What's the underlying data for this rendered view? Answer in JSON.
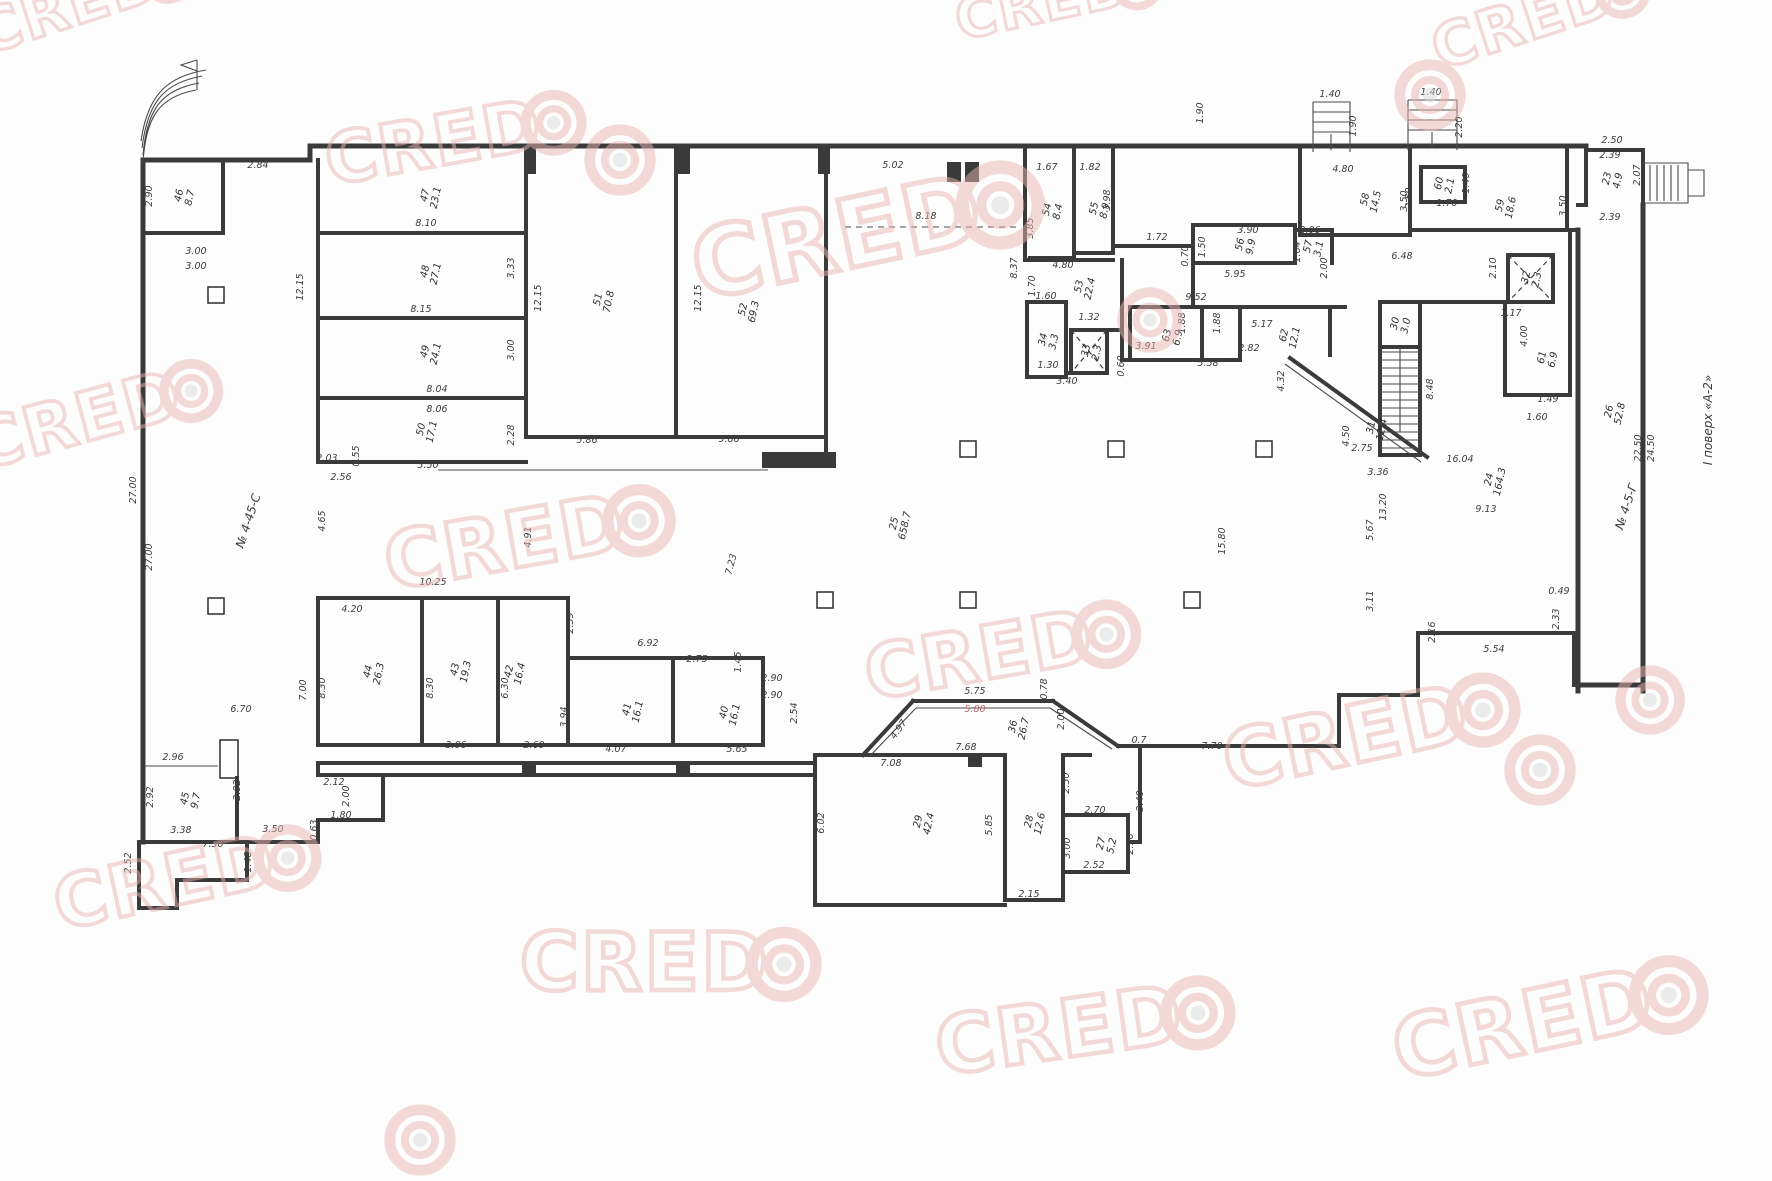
{
  "document": {
    "type": "floor-plan-scan",
    "floor_note": "І поверх «А-2»",
    "annotations": [
      {
        "t": "№ 4-45-С",
        "x": 252,
        "y": 522,
        "r": -72
      },
      {
        "t": "№ 4-5-Г",
        "x": 1630,
        "y": 508,
        "r": -72
      },
      {
        "t": "І поверх «А-2»",
        "x": 1712,
        "y": 420,
        "r": -90
      }
    ]
  },
  "watermark": {
    "text": "CRED",
    "color": "#e9b2b2",
    "center_color": "#d9d9d9",
    "opacity": 0.5,
    "items": [
      {
        "x": -15,
        "y": 55,
        "s": 60,
        "r": -18,
        "t": "logo"
      },
      {
        "x": 960,
        "y": 40,
        "s": 56,
        "r": -12,
        "t": "logo"
      },
      {
        "x": 1440,
        "y": 70,
        "s": 60,
        "r": -18,
        "t": "logo"
      },
      {
        "x": 330,
        "y": 185,
        "s": 70,
        "r": -10,
        "t": "logo"
      },
      {
        "x": 620,
        "y": 160,
        "s": 72,
        "r": 0,
        "t": "target"
      },
      {
        "x": 700,
        "y": 300,
        "s": 95,
        "r": -12,
        "t": "logo"
      },
      {
        "x": 1150,
        "y": 320,
        "s": 66,
        "r": 0,
        "t": "target"
      },
      {
        "x": 1430,
        "y": 95,
        "s": 72,
        "r": 0,
        "t": "target"
      },
      {
        "x": -20,
        "y": 470,
        "s": 68,
        "r": -15,
        "t": "logo"
      },
      {
        "x": 390,
        "y": 590,
        "s": 78,
        "r": -10,
        "t": "logo"
      },
      {
        "x": 870,
        "y": 700,
        "s": 74,
        "r": -10,
        "t": "logo"
      },
      {
        "x": 1230,
        "y": 790,
        "s": 80,
        "r": -12,
        "t": "logo"
      },
      {
        "x": 1540,
        "y": 770,
        "s": 72,
        "r": 0,
        "t": "target"
      },
      {
        "x": 60,
        "y": 930,
        "s": 72,
        "r": -12,
        "t": "logo"
      },
      {
        "x": 520,
        "y": 990,
        "s": 80,
        "r": 0,
        "t": "logo"
      },
      {
        "x": 940,
        "y": 1075,
        "s": 80,
        "r": -8,
        "t": "logo"
      },
      {
        "x": 1400,
        "y": 1080,
        "s": 85,
        "r": -12,
        "t": "logo"
      },
      {
        "x": 420,
        "y": 1140,
        "s": 72,
        "r": 0,
        "t": "target"
      },
      {
        "x": 1650,
        "y": 700,
        "s": 70,
        "r": 0,
        "t": "target"
      }
    ]
  },
  "rooms": [
    {
      "num": "46",
      "area": "8.7",
      "x": 182,
      "y": 196
    },
    {
      "num": "47",
      "area": "23.1",
      "x": 428,
      "y": 196
    },
    {
      "num": "48",
      "area": "27.1",
      "x": 428,
      "y": 272
    },
    {
      "num": "49",
      "area": "24.1",
      "x": 428,
      "y": 352
    },
    {
      "num": "50",
      "area": "17.1",
      "x": 424,
      "y": 430
    },
    {
      "num": "51",
      "area": "70.8",
      "x": 601,
      "y": 300
    },
    {
      "num": "52",
      "area": "69.3",
      "x": 746,
      "y": 310
    },
    {
      "num": "53",
      "area": "22.4",
      "x": 1082,
      "y": 287
    },
    {
      "num": "54",
      "area": "8.4",
      "x": 1050,
      "y": 210
    },
    {
      "num": "55",
      "area": "8.9",
      "x": 1097,
      "y": 209
    },
    {
      "num": "56",
      "area": "9.9",
      "x": 1243,
      "y": 245
    },
    {
      "num": "57",
      "area": "3.1",
      "x": 1311,
      "y": 247
    },
    {
      "num": "58",
      "area": "14.5",
      "x": 1368,
      "y": 200
    },
    {
      "num": "59",
      "area": "18.6",
      "x": 1503,
      "y": 206
    },
    {
      "num": "60",
      "area": "2.1",
      "x": 1442,
      "y": 184
    },
    {
      "num": "61",
      "area": "6.9",
      "x": 1545,
      "y": 358
    },
    {
      "num": "62",
      "area": "12.1",
      "x": 1287,
      "y": 336
    },
    {
      "num": "63",
      "area": "6.9",
      "x": 1170,
      "y": 336
    },
    {
      "num": "34",
      "area": "3.3",
      "x": 1046,
      "y": 340
    },
    {
      "num": "33",
      "area": "2.3",
      "x": 1089,
      "y": 351
    },
    {
      "num": "32",
      "area": "2.3",
      "x": 1529,
      "y": 278
    },
    {
      "num": "30",
      "area": "3.0",
      "x": 1398,
      "y": 324
    },
    {
      "num": "31",
      "area": "12.4",
      "x": 1374,
      "y": 428
    },
    {
      "num": "36",
      "area": "26.7",
      "x": 1016,
      "y": 727
    },
    {
      "num": "29",
      "area": "42.4",
      "x": 921,
      "y": 822
    },
    {
      "num": "28",
      "area": "12.6",
      "x": 1032,
      "y": 822
    },
    {
      "num": "27",
      "area": "5.2",
      "x": 1104,
      "y": 844
    },
    {
      "num": "45",
      "area": "9.7",
      "x": 188,
      "y": 799
    },
    {
      "num": "44",
      "area": "26.3",
      "x": 371,
      "y": 672
    },
    {
      "num": "43",
      "area": "19.3",
      "x": 458,
      "y": 670
    },
    {
      "num": "42",
      "area": "16.4",
      "x": 512,
      "y": 672
    },
    {
      "num": "41",
      "area": "16.1",
      "x": 630,
      "y": 710
    },
    {
      "num": "40",
      "area": "16.1",
      "x": 727,
      "y": 713
    },
    {
      "num": "25",
      "area": "658.7",
      "x": 897,
      "y": 524
    },
    {
      "num": "24",
      "area": "164.3",
      "x": 1492,
      "y": 480
    },
    {
      "num": "26",
      "area": "52.8",
      "x": 1612,
      "y": 412
    },
    {
      "num": "23",
      "area": "4.9",
      "x": 1610,
      "y": 179
    }
  ],
  "dims": [
    {
      "t": "2.84",
      "x": 258,
      "y": 168,
      "r": 0
    },
    {
      "t": "2.90",
      "x": 152,
      "y": 196,
      "r": 90
    },
    {
      "t": "3.00",
      "x": 196,
      "y": 254,
      "r": 0
    },
    {
      "t": "3.00",
      "x": 196,
      "y": 269,
      "r": 0
    },
    {
      "t": "8.10",
      "x": 426,
      "y": 226,
      "r": 0
    },
    {
      "t": "12.15",
      "x": 303,
      "y": 287,
      "r": 90
    },
    {
      "t": "3.33",
      "x": 514,
      "y": 268,
      "r": 90
    },
    {
      "t": "8.15",
      "x": 421,
      "y": 312,
      "r": 0
    },
    {
      "t": "3.00",
      "x": 514,
      "y": 350,
      "r": 90
    },
    {
      "t": "8.04",
      "x": 437,
      "y": 392,
      "r": 0
    },
    {
      "t": "8.06",
      "x": 437,
      "y": 412,
      "r": 0
    },
    {
      "t": "2.28",
      "x": 514,
      "y": 435,
      "r": 90
    },
    {
      "t": "2.03",
      "x": 327,
      "y": 461,
      "r": 0
    },
    {
      "t": "2.56",
      "x": 341,
      "y": 480,
      "r": 0
    },
    {
      "t": "0.55",
      "x": 359,
      "y": 456,
      "r": 90
    },
    {
      "t": "5.50",
      "x": 428,
      "y": 468,
      "r": 0
    },
    {
      "t": "12.15",
      "x": 541,
      "y": 298,
      "r": 90
    },
    {
      "t": "12.15",
      "x": 701,
      "y": 298,
      "r": 90
    },
    {
      "t": "5.86",
      "x": 587,
      "y": 443,
      "r": 0
    },
    {
      "t": "5.86",
      "x": 729,
      "y": 442,
      "r": 0
    },
    {
      "t": "5.02",
      "x": 893,
      "y": 168,
      "r": 0
    },
    {
      "t": "8.18",
      "x": 926,
      "y": 219,
      "r": 0
    },
    {
      "t": "1.67",
      "x": 1047,
      "y": 170,
      "r": 0
    },
    {
      "t": "1.82",
      "x": 1090,
      "y": 170,
      "r": 0
    },
    {
      "t": "3.98",
      "x": 1110,
      "y": 200,
      "r": 90
    },
    {
      "t": "3.85",
      "x": 1033,
      "y": 228,
      "r": 90
    },
    {
      "t": "8.37",
      "x": 1017,
      "y": 268,
      "r": 90
    },
    {
      "t": "1.70",
      "x": 1035,
      "y": 286,
      "r": 90
    },
    {
      "t": "4.80",
      "x": 1063,
      "y": 268,
      "r": 0
    },
    {
      "t": "1.72",
      "x": 1157,
      "y": 240,
      "r": 0
    },
    {
      "t": "0.70",
      "x": 1188,
      "y": 256,
      "r": 90
    },
    {
      "t": "3.90",
      "x": 1248,
      "y": 233,
      "r": 0
    },
    {
      "t": "1.50",
      "x": 1205,
      "y": 247,
      "r": 90
    },
    {
      "t": "5.95",
      "x": 1235,
      "y": 277,
      "r": 0
    },
    {
      "t": "2.06",
      "x": 1310,
      "y": 233,
      "r": 0
    },
    {
      "t": "1.64",
      "x": 1300,
      "y": 252,
      "r": 90
    },
    {
      "t": "2.00",
      "x": 1327,
      "y": 268,
      "r": 90
    },
    {
      "t": "9.52",
      "x": 1196,
      "y": 300,
      "r": 0
    },
    {
      "t": "1.60",
      "x": 1046,
      "y": 299,
      "r": 0
    },
    {
      "t": "1.32",
      "x": 1089,
      "y": 320,
      "r": 0
    },
    {
      "t": "1.30",
      "x": 1048,
      "y": 368,
      "r": 0
    },
    {
      "t": "3.40",
      "x": 1067,
      "y": 384,
      "r": 0
    },
    {
      "t": "3.91",
      "x": 1146,
      "y": 349,
      "r": 0
    },
    {
      "t": "0.60",
      "x": 1124,
      "y": 366,
      "r": 90
    },
    {
      "t": "5.58",
      "x": 1208,
      "y": 366,
      "r": 0
    },
    {
      "t": "1.88",
      "x": 1185,
      "y": 323,
      "r": 90
    },
    {
      "t": "1.88",
      "x": 1220,
      "y": 323,
      "r": 90
    },
    {
      "t": "5.17",
      "x": 1262,
      "y": 327,
      "r": 0
    },
    {
      "t": "2.82",
      "x": 1249,
      "y": 351,
      "r": 0
    },
    {
      "t": "4.32",
      "x": 1284,
      "y": 381,
      "r": 90
    },
    {
      "t": "2.75",
      "x": 1362,
      "y": 451,
      "r": 0
    },
    {
      "t": "3.36",
      "x": 1378,
      "y": 475,
      "r": 0
    },
    {
      "t": "4.50",
      "x": 1349,
      "y": 436,
      "r": 90
    },
    {
      "t": "8.48",
      "x": 1433,
      "y": 389,
      "r": 90
    },
    {
      "t": "2.10",
      "x": 1496,
      "y": 268,
      "r": 90
    },
    {
      "t": "1.17",
      "x": 1511,
      "y": 316,
      "r": 0
    },
    {
      "t": "4.00",
      "x": 1527,
      "y": 336,
      "r": 90
    },
    {
      "t": "1.49",
      "x": 1548,
      "y": 402,
      "r": 0
    },
    {
      "t": "1.60",
      "x": 1537,
      "y": 420,
      "r": 0
    },
    {
      "t": "4.80",
      "x": 1343,
      "y": 172,
      "r": 0
    },
    {
      "t": "2.50",
      "x": 1412,
      "y": 198,
      "r": 90
    },
    {
      "t": "6.48",
      "x": 1402,
      "y": 259,
      "r": 0
    },
    {
      "t": "1.40",
      "x": 1330,
      "y": 97,
      "r": 0
    },
    {
      "t": "1.90",
      "x": 1356,
      "y": 126,
      "r": 90
    },
    {
      "t": "1.40",
      "x": 1431,
      "y": 95,
      "r": 0
    },
    {
      "t": "2.20",
      "x": 1462,
      "y": 127,
      "r": 90
    },
    {
      "t": "1.70",
      "x": 1447,
      "y": 206,
      "r": 0
    },
    {
      "t": "1.40",
      "x": 1469,
      "y": 183,
      "r": 90
    },
    {
      "t": "3.50",
      "x": 1407,
      "y": 201,
      "r": 90
    },
    {
      "t": "3.50",
      "x": 1566,
      "y": 206,
      "r": 90
    },
    {
      "t": "2.50",
      "x": 1612,
      "y": 143,
      "r": 0
    },
    {
      "t": "2.39",
      "x": 1610,
      "y": 158,
      "r": 0
    },
    {
      "t": "2.07",
      "x": 1640,
      "y": 175,
      "r": 90
    },
    {
      "t": "2.39",
      "x": 1610,
      "y": 220,
      "r": 0
    },
    {
      "t": "24.50",
      "x": 1654,
      "y": 448,
      "r": 90
    },
    {
      "t": "22.50",
      "x": 1641,
      "y": 448,
      "r": 90
    },
    {
      "t": "27.00",
      "x": 136,
      "y": 490,
      "r": 90
    },
    {
      "t": "27.00",
      "x": 152,
      "y": 557,
      "r": 90
    },
    {
      "t": "4.65",
      "x": 325,
      "y": 521,
      "r": 90
    },
    {
      "t": "4.91",
      "x": 531,
      "y": 537,
      "r": 90
    },
    {
      "t": "7.23",
      "x": 734,
      "y": 565,
      "r": 75
    },
    {
      "t": "15.80",
      "x": 1225,
      "y": 541,
      "r": 90
    },
    {
      "t": "16.04",
      "x": 1460,
      "y": 462,
      "r": 0
    },
    {
      "t": "9.13",
      "x": 1486,
      "y": 512,
      "r": 0
    },
    {
      "t": "13.20",
      "x": 1386,
      "y": 507,
      "r": 90
    },
    {
      "t": "5.67",
      "x": 1373,
      "y": 530,
      "r": 90
    },
    {
      "t": "3.11",
      "x": 1373,
      "y": 601,
      "r": 90
    },
    {
      "t": "2.16",
      "x": 1435,
      "y": 632,
      "r": 90
    },
    {
      "t": "5.54",
      "x": 1494,
      "y": 652,
      "r": 0
    },
    {
      "t": "2.33",
      "x": 1559,
      "y": 619,
      "r": 90
    },
    {
      "t": "0.49",
      "x": 1559,
      "y": 594,
      "r": 0
    },
    {
      "t": "10.25",
      "x": 433,
      "y": 585,
      "r": 0
    },
    {
      "t": "4.20",
      "x": 352,
      "y": 612,
      "r": 0
    },
    {
      "t": "2.39",
      "x": 573,
      "y": 623,
      "r": 90
    },
    {
      "t": "6.92",
      "x": 648,
      "y": 646,
      "r": 0
    },
    {
      "t": "2.75",
      "x": 697,
      "y": 662,
      "r": 0
    },
    {
      "t": "1.45",
      "x": 741,
      "y": 662,
      "r": 90
    },
    {
      "t": "2.90",
      "x": 772,
      "y": 681,
      "r": 0
    },
    {
      "t": "2.90",
      "x": 772,
      "y": 698,
      "r": 0
    },
    {
      "t": "2.54",
      "x": 797,
      "y": 713,
      "r": 90
    },
    {
      "t": "7.00",
      "x": 306,
      "y": 690,
      "r": 90
    },
    {
      "t": "8.30",
      "x": 325,
      "y": 688,
      "r": 90
    },
    {
      "t": "8.30",
      "x": 433,
      "y": 688,
      "r": 90
    },
    {
      "t": "6.30",
      "x": 508,
      "y": 688,
      "r": 90
    },
    {
      "t": "3.94",
      "x": 567,
      "y": 717,
      "r": 90
    },
    {
      "t": "3.06",
      "x": 456,
      "y": 748,
      "r": 0
    },
    {
      "t": "2.60",
      "x": 534,
      "y": 748,
      "r": 0
    },
    {
      "t": "4.07",
      "x": 616,
      "y": 752,
      "r": 0
    },
    {
      "t": "5.65",
      "x": 737,
      "y": 752,
      "r": 0
    },
    {
      "t": "6.02",
      "x": 824,
      "y": 823,
      "r": 90
    },
    {
      "t": "5.85",
      "x": 992,
      "y": 825,
      "r": 90
    },
    {
      "t": "7.08",
      "x": 891,
      "y": 766,
      "r": 0
    },
    {
      "t": "7.68",
      "x": 966,
      "y": 750,
      "r": 0
    },
    {
      "t": "5.75",
      "x": 975,
      "y": 694,
      "r": 0
    },
    {
      "t": "5.80",
      "x": 975,
      "y": 712,
      "r": 0,
      "red": true
    },
    {
      "t": "4.97",
      "x": 901,
      "y": 731,
      "r": 55
    },
    {
      "t": "2.00",
      "x": 1064,
      "y": 719,
      "r": 90
    },
    {
      "t": "0.78",
      "x": 1047,
      "y": 689,
      "r": 90
    },
    {
      "t": "0.7",
      "x": 1139,
      "y": 743,
      "r": 0
    },
    {
      "t": "7.70",
      "x": 1212,
      "y": 749,
      "r": 0
    },
    {
      "t": "2.15",
      "x": 1029,
      "y": 897,
      "r": 0
    },
    {
      "t": "2.52",
      "x": 1094,
      "y": 868,
      "r": 0
    },
    {
      "t": "2.70",
      "x": 1095,
      "y": 813,
      "r": 0
    },
    {
      "t": "3.00",
      "x": 1070,
      "y": 848,
      "r": 90
    },
    {
      "t": "2.16",
      "x": 1133,
      "y": 844,
      "r": 90
    },
    {
      "t": "3.40",
      "x": 1143,
      "y": 801,
      "r": 90
    },
    {
      "t": "2.50",
      "x": 1069,
      "y": 783,
      "r": 90
    },
    {
      "t": "6.70",
      "x": 241,
      "y": 712,
      "r": 0
    },
    {
      "t": "2.96",
      "x": 173,
      "y": 760,
      "r": 0
    },
    {
      "t": "2.92",
      "x": 153,
      "y": 797,
      "r": 90
    },
    {
      "t": "2.92",
      "x": 240,
      "y": 790,
      "r": 90
    },
    {
      "t": "3.38",
      "x": 181,
      "y": 833,
      "r": 0
    },
    {
      "t": "7.30",
      "x": 213,
      "y": 847,
      "r": 0
    },
    {
      "t": "3.50",
      "x": 273,
      "y": 832,
      "r": 0
    },
    {
      "t": "1.80",
      "x": 341,
      "y": 818,
      "r": 0
    },
    {
      "t": "0.63",
      "x": 317,
      "y": 830,
      "r": 90
    },
    {
      "t": "2.12",
      "x": 334,
      "y": 785,
      "r": 0
    },
    {
      "t": "2.00",
      "x": 349,
      "y": 796,
      "r": 90
    },
    {
      "t": "2.52",
      "x": 131,
      "y": 863,
      "r": 90
    },
    {
      "t": "1.48",
      "x": 251,
      "y": 862,
      "r": 90
    },
    {
      "t": "1.90",
      "x": 1203,
      "y": 113,
      "r": 90
    }
  ]
}
